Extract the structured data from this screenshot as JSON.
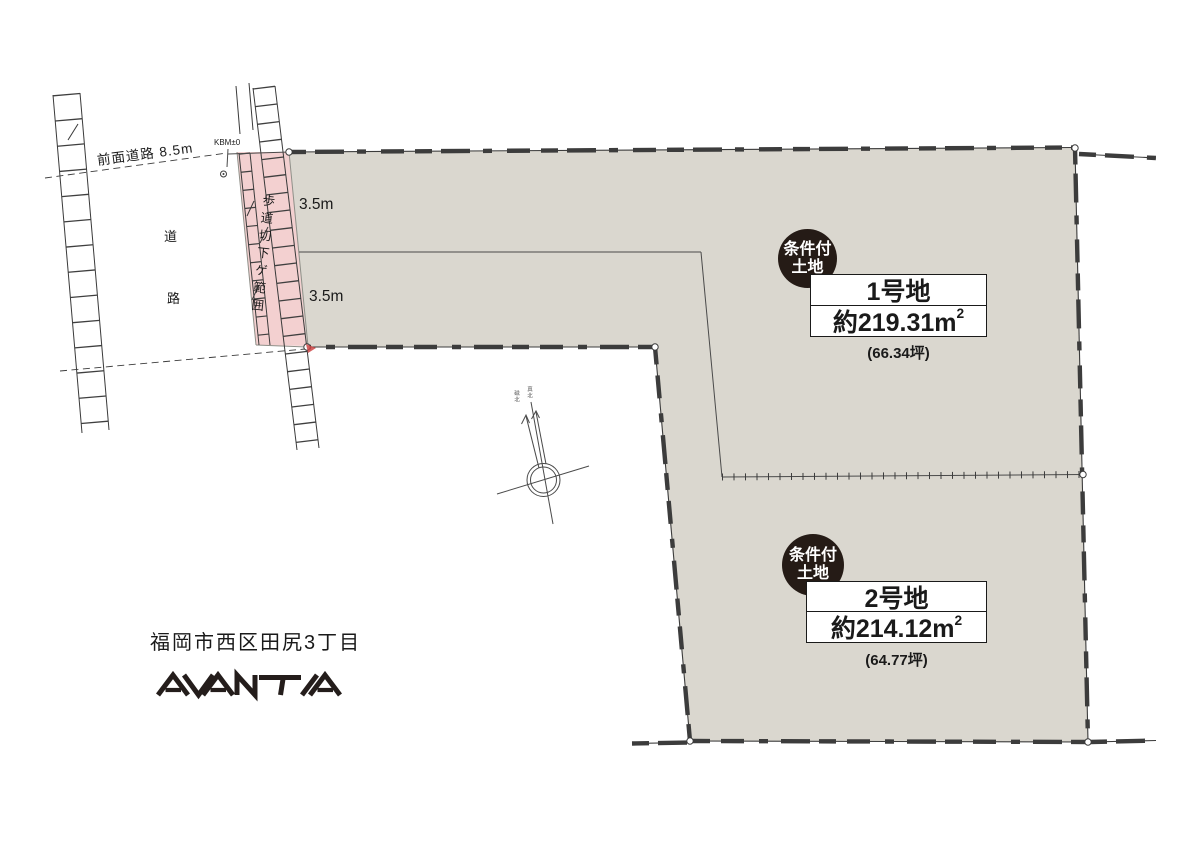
{
  "road": {
    "front_road_label": "前面道路 8.5m",
    "road_char_1": "道",
    "road_char_2": "路",
    "benchmark_label": "KBM±0",
    "setback_label": "歩道切下ゲ範囲",
    "strip_width_top": "3.5m",
    "strip_width_bottom": "3.5m"
  },
  "compass": {
    "magnetic_north": "磁北",
    "true_north": "真北"
  },
  "plot1": {
    "condition_badge_line1": "条件付",
    "condition_badge_line2": "土地",
    "name": "1号地",
    "area_text": "約219.31m",
    "area_sup": "2",
    "area_full": "約219.31㎡",
    "tsubo": "(66.34坪)"
  },
  "plot2": {
    "condition_badge_line1": "条件付",
    "condition_badge_line2": "土地",
    "name": "2号地",
    "area_text": "約214.12m",
    "area_sup": "2",
    "area_full": "約214.12㎡",
    "tsubo": "(64.77坪)"
  },
  "footer": {
    "address": "福岡市西区田尻3丁目",
    "brand": "AVANTIA"
  },
  "colors": {
    "parcel_fill": "#dad7cf",
    "setback_pink": "#f3d0d0",
    "badge_bg": "#251b16",
    "line": "#3c3c3c"
  }
}
